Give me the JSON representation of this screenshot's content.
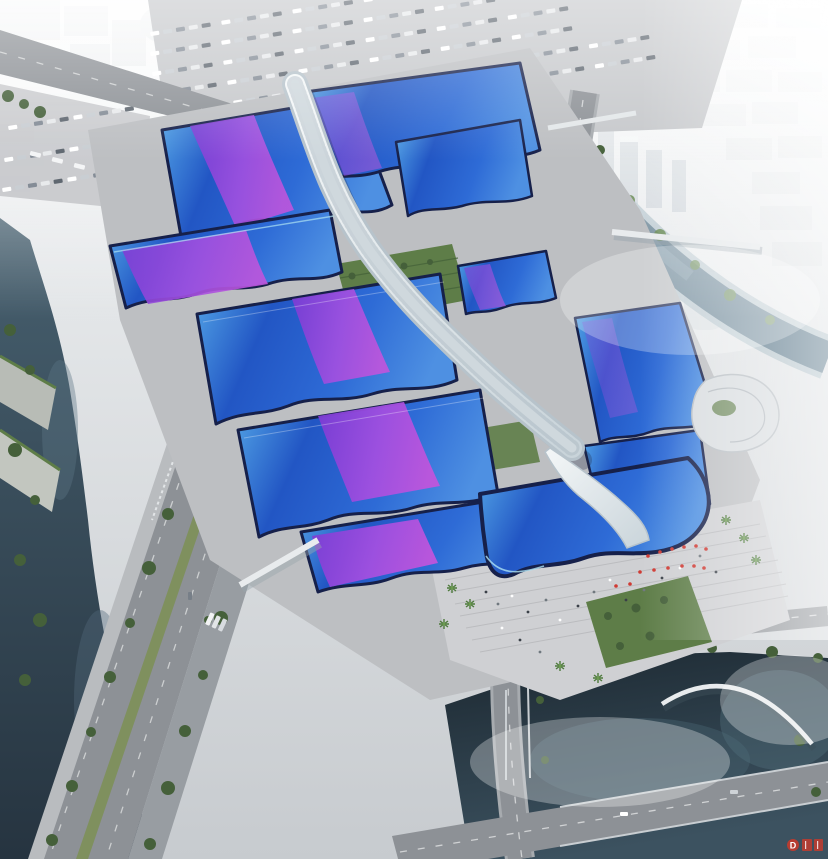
{
  "meta": {
    "title": "Aerial rendering of a riverside exhibition & convention center complex",
    "type": "architectural-rendering",
    "visible_text": "none except small red watermark badge at bottom right"
  },
  "watermark": {
    "badge_letter": "D",
    "color": "#c23b2e"
  },
  "palette": {
    "haze_top": "#f3f5f6",
    "haze_bottom": "#c7cbcf",
    "city_block": "#d3d8dc",
    "city_tower": "#c4ccd3",
    "water_river_light": "#47606f",
    "water_river_dark": "#263440",
    "water_lake_light": "#3c5260",
    "water_lake_dark": "#1c2831",
    "canal": "#5d7a8c",
    "canal_bank": "#a9bcc4",
    "road": "#8d9196",
    "road_secondary": "#989da2",
    "road_dash": "#d8dadb",
    "plaza": "#bdbfc2",
    "plaza_light": "#cfd0d3",
    "parking": "#c6c8cb",
    "sidewalk": "#b9bcbf",
    "tree": "#45603a",
    "tree_light": "#6e8f5a",
    "lawn": "#5e7d48",
    "median_green": "#7d9058",
    "roof_blue_light": "#55a8e8",
    "roof_blue_deep": "#2256c4",
    "roof_blue": "#2e6bd6",
    "roof_blue_soft": "#4e90e2",
    "roof_navy": "#16204a",
    "roof_cyan_trim": "#aee2f2",
    "ribbon_purple": "#7c3cd4",
    "ribbon_mid": "#a24fe0",
    "ribbon_magenta": "#bf55dc",
    "spine_light": "#f4f7f8",
    "spine_shade": "#c9d4da",
    "green_roof": "#6b7a41",
    "building_white": "#d9dde0",
    "bridge_white": "#e8ebed",
    "red_accent": "#cf3a33"
  }
}
